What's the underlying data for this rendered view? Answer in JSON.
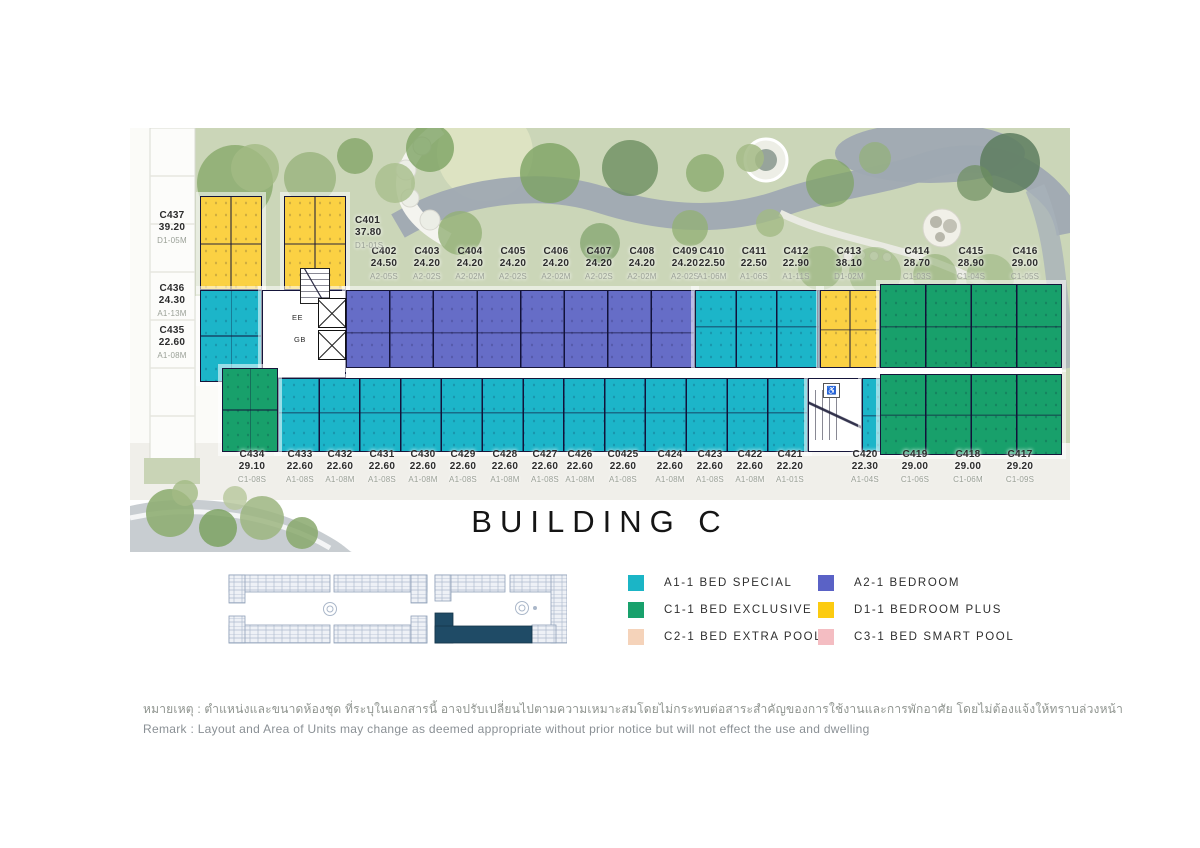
{
  "page": {
    "title": "BUILDING C"
  },
  "plan": {
    "core_labels": {
      "ee": "EE",
      "gb": "GB",
      "access": "♿"
    },
    "left_column_units": [
      {
        "no": "C437",
        "area": "39.20",
        "type": "D1-05M"
      },
      {
        "no": "C436",
        "area": "24.30",
        "type": "A1-13M"
      },
      {
        "no": "C435",
        "area": "22.60",
        "type": "A1-08M"
      }
    ],
    "c401": {
      "no": "C401",
      "area": "37.80",
      "type": "D1-01S"
    },
    "top_row_units": [
      {
        "no": "C402",
        "area": "24.50",
        "type": "A2-05S"
      },
      {
        "no": "C403",
        "area": "24.20",
        "type": "A2-02S"
      },
      {
        "no": "C404",
        "area": "24.20",
        "type": "A2-02M"
      },
      {
        "no": "C405",
        "area": "24.20",
        "type": "A2-02S"
      },
      {
        "no": "C406",
        "area": "24.20",
        "type": "A2-02M"
      },
      {
        "no": "C407",
        "area": "24.20",
        "type": "A2-02S"
      },
      {
        "no": "C408",
        "area": "24.20",
        "type": "A2-02M"
      },
      {
        "no": "C409",
        "area": "24.20",
        "type": "A2-02S"
      },
      {
        "no": "C410",
        "area": "22.50",
        "type": "A1-06M"
      },
      {
        "no": "C411",
        "area": "22.50",
        "type": "A1-06S"
      },
      {
        "no": "C412",
        "area": "22.90",
        "type": "A1-11S"
      },
      {
        "no": "C413",
        "area": "38.10",
        "type": "D1-02M"
      },
      {
        "no": "C414",
        "area": "28.70",
        "type": "C1-03S"
      },
      {
        "no": "C415",
        "area": "28.90",
        "type": "C1-04S"
      },
      {
        "no": "C416",
        "area": "29.00",
        "type": "C1-05S"
      }
    ],
    "bottom_row_units": [
      {
        "no": "C434",
        "area": "29.10",
        "type": "C1-08S"
      },
      {
        "no": "C433",
        "area": "22.60",
        "type": "A1-08S"
      },
      {
        "no": "C432",
        "area": "22.60",
        "type": "A1-08M"
      },
      {
        "no": "C431",
        "area": "22.60",
        "type": "A1-08S"
      },
      {
        "no": "C430",
        "area": "22.60",
        "type": "A1-08M"
      },
      {
        "no": "C429",
        "area": "22.60",
        "type": "A1-08S"
      },
      {
        "no": "C428",
        "area": "22.60",
        "type": "A1-08M"
      },
      {
        "no": "C427",
        "area": "22.60",
        "type": "A1-08S"
      },
      {
        "no": "C426",
        "area": "22.60",
        "type": "A1-08M"
      },
      {
        "no": "C0425",
        "area": "22.60",
        "type": "A1-08S"
      },
      {
        "no": "C424",
        "area": "22.60",
        "type": "A1-08M"
      },
      {
        "no": "C423",
        "area": "22.60",
        "type": "A1-08S"
      },
      {
        "no": "C422",
        "area": "22.60",
        "type": "A1-08M"
      },
      {
        "no": "C421",
        "area": "22.20",
        "type": "A1-01S"
      },
      {
        "no": "C420",
        "area": "22.30",
        "type": "A1-04S"
      },
      {
        "no": "C419",
        "area": "29.00",
        "type": "C1-06S"
      },
      {
        "no": "C418",
        "area": "29.00",
        "type": "C1-06M"
      },
      {
        "no": "C417",
        "area": "29.20",
        "type": "C1-09S"
      }
    ]
  },
  "legend": {
    "items": [
      {
        "code": "A1",
        "label": "A1-1 BED SPECIAL",
        "color": "#1bb5c6"
      },
      {
        "code": "C1",
        "label": "C1-1 BED EXCLUSIVE",
        "color": "#18a16c"
      },
      {
        "code": "C2",
        "label": "C2-1 BED EXTRA POOL",
        "color": "#f5d3ba"
      },
      {
        "code": "A2",
        "label": "A2-1 BEDROOM",
        "color": "#5a62c6"
      },
      {
        "code": "D1",
        "label": "D1-1 BEDROOM PLUS",
        "color": "#fccb10"
      },
      {
        "code": "C3",
        "label": "C3-1 BED SMART POOL",
        "color": "#f4bdc2"
      }
    ]
  },
  "remark": {
    "thai": "หมายเหตุ : ตำแหน่งและขนาดห้องชุด ที่ระบุในเอกสารนี้ อาจปรับเปลี่ยนไปตามความเหมาะสมโดยไม่กระทบต่อสาระสำคัญของการใช้งานและการพักอาศัย โดยไม่ต้องแจ้งให้ทราบล่วงหน้า",
    "english": "Remark : Layout and Area of Units may change as deemed appropriate without prior notice but will not effect the use and dwelling"
  },
  "colors": {
    "a1_teal": "#1cb5c9",
    "c1_green": "#18a06b",
    "a2_blue": "#666dc7",
    "d1_yellow": "#fbd143",
    "c2_peach": "#f5d3ba",
    "c3_pink": "#f4bdc2",
    "keyplan_highlight": "#1f4b66"
  }
}
